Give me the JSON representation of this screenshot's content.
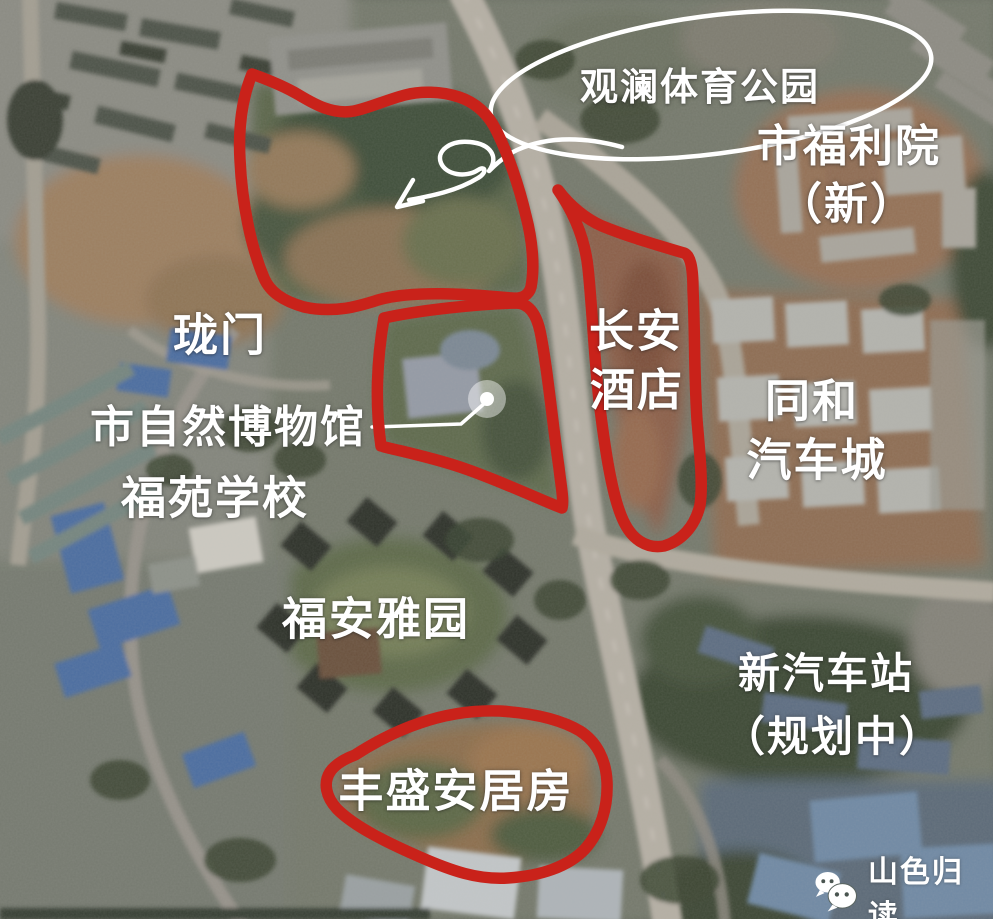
{
  "map": {
    "labels": {
      "park": "观澜体育公园",
      "welfare_line1": "市福利院",
      "welfare_line2": "（新）",
      "longmen": "珑门",
      "museum": "市自然博物馆",
      "school": "福苑学校",
      "changan_line1": "长安",
      "changan_line2": "酒店",
      "tonghe_line1": "同和",
      "tonghe_line2": "汽车城",
      "fuanyayuan": "福安雅园",
      "new_station_line1": "新汽车站",
      "new_station_line2": "（规划中）",
      "fengsheng": "丰盛安居房"
    },
    "colors": {
      "annotation_red": "#c9221a",
      "annotation_white": "#ffffff"
    }
  },
  "watermark": {
    "icon": "wechat-icon",
    "text": "山色归读"
  }
}
